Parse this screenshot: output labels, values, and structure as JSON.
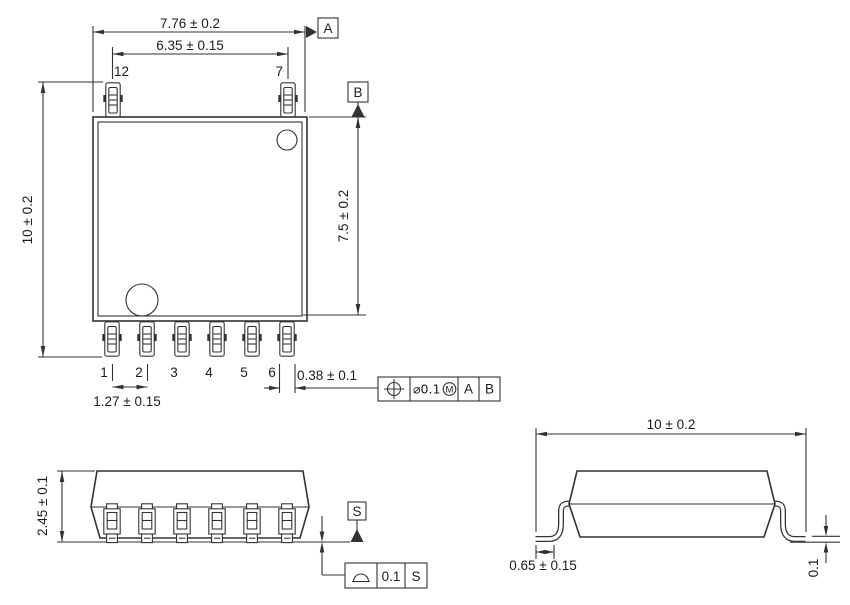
{
  "drawing": {
    "background": "#ffffff",
    "line_color": "#333333",
    "text_color": "#1c1c1c",
    "top_view": {
      "dim_body_width": "7.76 ± 0.2",
      "dim_lead_span_top": "6.35 ± 0.15",
      "dim_overall_length": "10 ± 0.2",
      "dim_body_length": "7.5 ± 0.2",
      "dim_lead_pitch": "1.27 ± 0.15",
      "dim_lead_width": "0.38 ± 0.1",
      "pin_top_left": "12",
      "pin_top_right": "7",
      "pin_numbers": [
        "1",
        "2",
        "3",
        "4",
        "5",
        "6"
      ],
      "datum_a": "A",
      "datum_b": "B",
      "fcf_position": {
        "symbol": "true-position",
        "tolerance": "⌀0.1",
        "modifier": "M",
        "datum_1": "A",
        "datum_2": "B"
      }
    },
    "side_view": {
      "dim_height": "2.45 ± 0.1",
      "datum_s": "S",
      "fcf_seating": {
        "symbol": "seating-plane",
        "tolerance": "0.1",
        "datum": "S"
      }
    },
    "end_view": {
      "dim_overall_width": "10 ± 0.2",
      "dim_foot_length": "0.65 ± 0.15",
      "dim_standoff": "0.1"
    }
  }
}
